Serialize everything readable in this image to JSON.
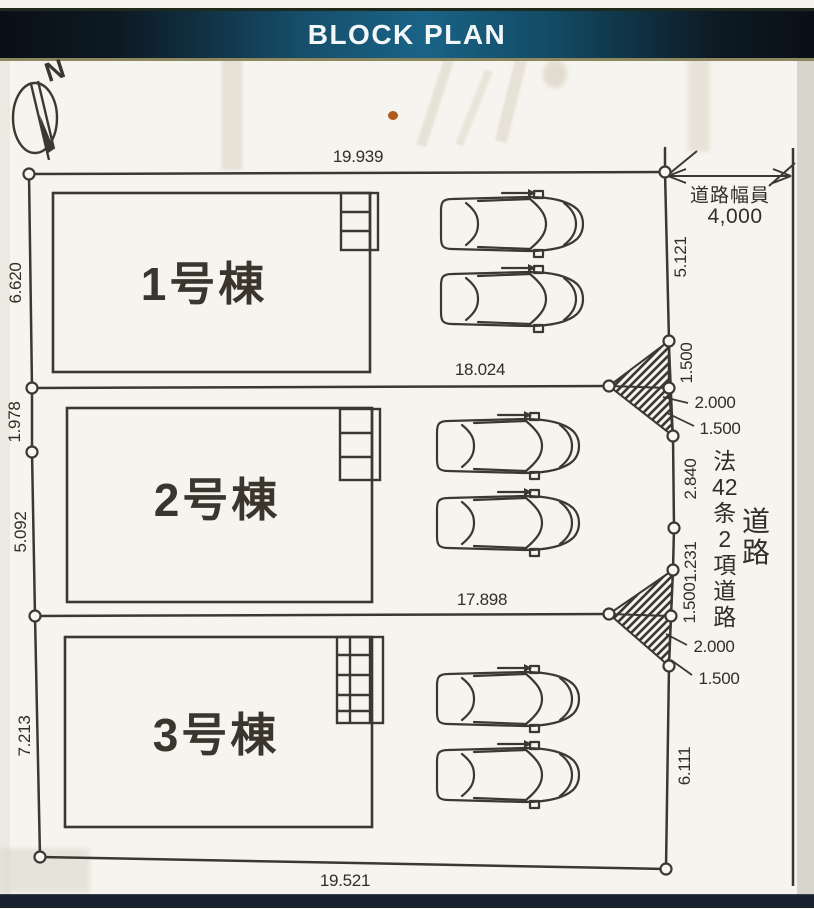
{
  "banner": {
    "title": "BLOCK PLAN"
  },
  "compass": {
    "north_label": "N"
  },
  "lots": [
    {
      "name": "1号棟"
    },
    {
      "name": "2号棟"
    },
    {
      "name": "3号棟"
    }
  ],
  "dims": {
    "top": "19.939",
    "lot1_bottom": "18.024",
    "lot2_bottom": "17.898",
    "bottom": "19.521",
    "left": {
      "l1": "6.620",
      "l2": "1.978",
      "l3": "5.092",
      "l4": "7.213"
    },
    "right": {
      "r1": "5.121",
      "r2": "1.500",
      "r3": "2.000",
      "r4": "1.500",
      "r5": "2.840",
      "r6": "1.231",
      "r7": "1.500",
      "r8": "2.000",
      "r9": "1.500",
      "r10": "6.111"
    }
  },
  "road": {
    "width_label": "道路幅員",
    "width_value": "4,000",
    "law_label": "法42条2項道路",
    "law_chars": {
      "c1": "法",
      "c2": "42",
      "c3": "条",
      "c4": "2",
      "c5": "項",
      "c6": "道",
      "c7": "路"
    },
    "name_label": "道路",
    "name_chars": {
      "c1": "道",
      "c2": "路"
    }
  },
  "colors": {
    "banner_teal": "#1a6386",
    "ink": "#3c3831",
    "bottom_bar": "#18222f"
  }
}
